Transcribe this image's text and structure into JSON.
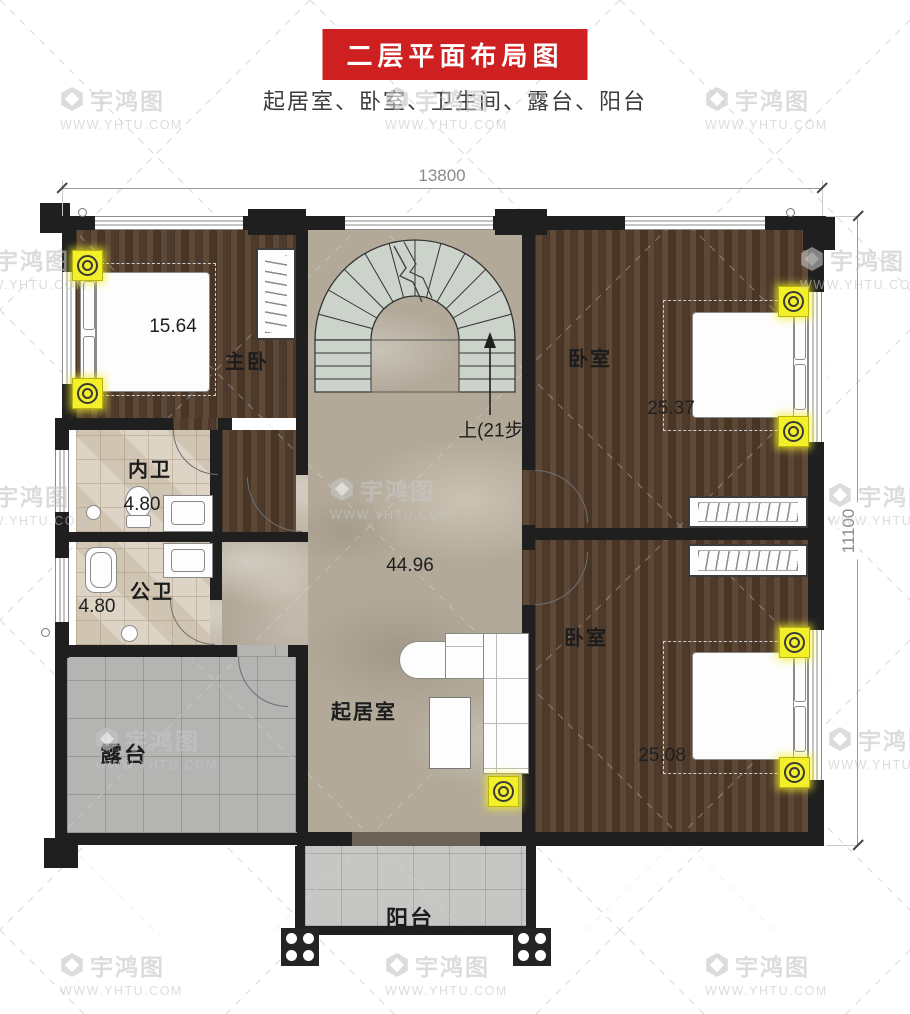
{
  "title": "二层平面布局图",
  "subtitle": "起居室、卧室、卫生间、露台、阳台",
  "dimensions": {
    "width_mm": "13800",
    "height_mm": "11100"
  },
  "stairs": {
    "direction_note": "上(21步)"
  },
  "rooms": {
    "master": {
      "label": "主卧",
      "area": "15.64"
    },
    "bedroom_ne": {
      "label": "卧室",
      "area": "25.37"
    },
    "bedroom_se": {
      "label": "卧室",
      "area": "25.08"
    },
    "bath_inner": {
      "label": "内卫",
      "area": "4.80"
    },
    "bath_public": {
      "label": "公卫",
      "area": "4.80"
    },
    "living": {
      "label": "起居室",
      "area": "44.96"
    },
    "terrace": {
      "label": "露台"
    },
    "balcony": {
      "label": "阳台"
    }
  },
  "watermark": {
    "brand": "宇鸿图",
    "url": "WWW.YHTU.COM"
  },
  "colors": {
    "banner_red": "#ce2020",
    "wall_black": "#1f1f1f",
    "spotlight_yellow": "#f3ef2a"
  }
}
